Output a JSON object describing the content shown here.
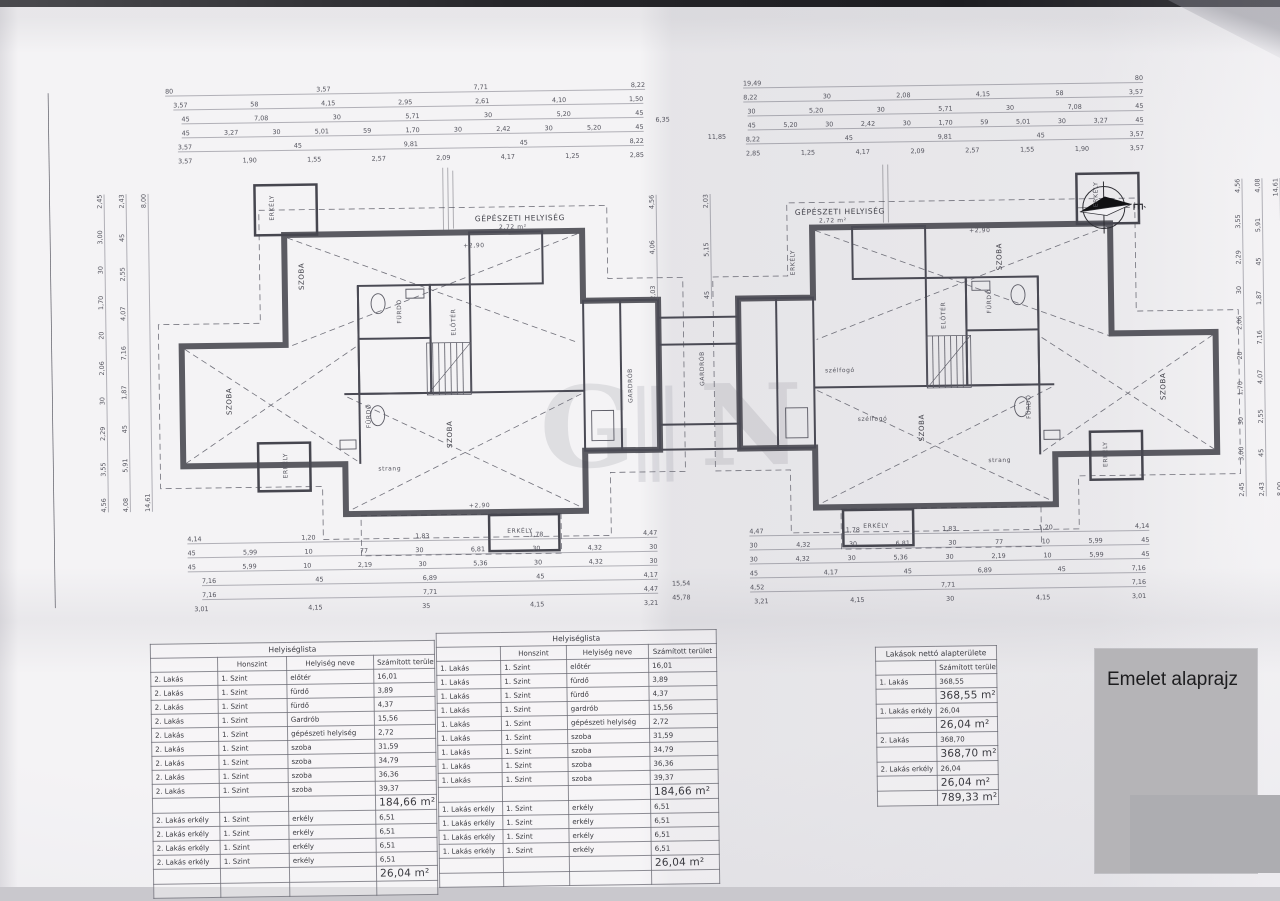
{
  "overlay": {
    "title": "Emelet alaprajz"
  },
  "compass": {
    "north_label": "É"
  },
  "watermark": {
    "letter_g": "G",
    "letter_n": "N"
  },
  "plan": {
    "labels": {
      "erkely": "ERKÉLY",
      "szoba": "SZOBA",
      "furdo": "FÜRDŐ",
      "eloter": "ELŐTÉR",
      "gardrob": "GARDRÓB",
      "gepeszeti": "GÉPÉSZETI HELYISÉG",
      "gepeszeti_area": "2,72 m²",
      "strang": "strang",
      "szelfogo": "szélfogó",
      "level": "+2,90"
    },
    "dims": {
      "top_l": [
        [
          "80",
          "3,57",
          "7,71",
          "8,22"
        ],
        [
          "3,57",
          "58",
          "4,15",
          "2,95",
          "2,61",
          "4,10",
          "1,50"
        ],
        [
          "45",
          "7,08",
          "30",
          "5,71",
          "30",
          "5,20",
          "45"
        ],
        [
          "45",
          "3,27",
          "30",
          "5,01",
          "59",
          "1,70",
          "30",
          "2,42",
          "30",
          "5,20",
          "45"
        ],
        [
          "3,57",
          "45",
          "9,81",
          "45",
          "8,22"
        ],
        [
          "3,57",
          "1,90",
          "1,55",
          "2,57",
          "2,09",
          "4,17",
          "1,25",
          "2,85"
        ]
      ],
      "top_r": [
        [
          "19,49",
          "80"
        ],
        [
          "8,22",
          "30",
          "2,08",
          "4,15",
          "58",
          "3,57"
        ],
        [
          "30",
          "5,20",
          "30",
          "5,71",
          "30",
          "7,08",
          "45"
        ],
        [
          "45",
          "5,20",
          "30",
          "2,42",
          "30",
          "1,70",
          "59",
          "5,01",
          "30",
          "3,27",
          "45"
        ],
        [
          "8,22",
          "45",
          "9,81",
          "45",
          "3,57"
        ],
        [
          "2,85",
          "1,25",
          "4,17",
          "2,09",
          "2,57",
          "1,55",
          "1,90",
          "3,57"
        ]
      ],
      "top_c": [
        "6,35",
        "11,85"
      ],
      "bot_l": [
        [
          "4,14",
          "1,20",
          "1,83",
          "1,78",
          "4,47"
        ],
        [
          "45",
          "5,99",
          "10",
          "77",
          "30",
          "6,81",
          "30",
          "4,32",
          "30"
        ],
        [
          "45",
          "5,99",
          "10",
          "2,19",
          "30",
          "5,36",
          "30",
          "4,32",
          "30"
        ],
        [
          "7,16",
          "45",
          "6,89",
          "45",
          "4,17"
        ],
        [
          "7,16",
          "7,71",
          "4,47"
        ],
        [
          "3,01",
          "4,15",
          "35",
          "4,15",
          "3,21"
        ]
      ],
      "bot_r": [
        [
          "4,47",
          "1,78",
          "1,83",
          "1,20",
          "4,14"
        ],
        [
          "30",
          "4,32",
          "30",
          "6,81",
          "30",
          "77",
          "10",
          "5,99",
          "45"
        ],
        [
          "30",
          "4,32",
          "30",
          "5,36",
          "30",
          "2,19",
          "10",
          "5,99",
          "45"
        ],
        [
          "45",
          "4,17",
          "45",
          "6,89",
          "45",
          "7,16"
        ],
        [
          "4,52",
          "7,71",
          "7,16"
        ],
        [
          "3,21",
          "4,15",
          "30",
          "4,15",
          "3,01"
        ]
      ],
      "bot_c": [
        "15,54",
        "45,78"
      ],
      "left_v": [
        [
          "4,56",
          "3,55",
          "2,29",
          "30",
          "2,06",
          "20",
          "1,70",
          "30",
          "3,00",
          "2,45"
        ],
        [
          "4,08",
          "5,91",
          "45",
          "1,87",
          "7,16",
          "4,07",
          "2,55",
          "45",
          "2,43"
        ],
        [
          "14,61",
          "8,00"
        ]
      ],
      "right_v": [
        [
          "2,45",
          "3,00",
          "30",
          "1,70",
          "20",
          "2,06",
          "30",
          "2,29",
          "3,55",
          "4,56"
        ],
        [
          "2,43",
          "45",
          "2,55",
          "4,07",
          "7,16",
          "1,87",
          "45",
          "5,91",
          "4,08"
        ],
        [
          "8,00",
          "14,61"
        ]
      ],
      "center_v": [
        [
          "2,03",
          "4,06",
          "4,56"
        ],
        [
          "45",
          "5,15",
          "2,03"
        ]
      ]
    }
  },
  "tables": {
    "left": {
      "title": "Helyiséglista",
      "col_headers": [
        "",
        "Honszint",
        "Helyiség neve",
        "Számított terület"
      ],
      "rows": [
        [
          "2. Lakás",
          "1. Szint",
          "előtér",
          "16,01"
        ],
        [
          "2. Lakás",
          "1. Szint",
          "fürdő",
          "3,89"
        ],
        [
          "2. Lakás",
          "1. Szint",
          "fürdő",
          "4,37"
        ],
        [
          "2. Lakás",
          "1. Szint",
          "Gardrób",
          "15,56"
        ],
        [
          "2. Lakás",
          "1. Szint",
          "gépészeti helyiség",
          "2,72"
        ],
        [
          "2. Lakás",
          "1. Szint",
          "szoba",
          "31,59"
        ],
        [
          "2. Lakás",
          "1. Szint",
          "szoba",
          "34,79"
        ],
        [
          "2. Lakás",
          "1. Szint",
          "szoba",
          "36,36"
        ],
        [
          "2. Lakás",
          "1. Szint",
          "szoba",
          "39,37"
        ],
        [
          "",
          "",
          "",
          "184,66 m²"
        ],
        [
          "2. Lakás erkély",
          "1. Szint",
          "erkély",
          "6,51"
        ],
        [
          "2. Lakás erkély",
          "1. Szint",
          "erkély",
          "6,51"
        ],
        [
          "2. Lakás erkély",
          "1. Szint",
          "erkély",
          "6,51"
        ],
        [
          "2. Lakás erkély",
          "1. Szint",
          "erkély",
          "6,51"
        ],
        [
          "",
          "",
          "",
          "26,04 m²"
        ],
        [
          "",
          "",
          "",
          ""
        ]
      ]
    },
    "middle": {
      "title": "Helyiséglista",
      "col_headers": [
        "",
        "Honszint",
        "Helyiség neve",
        "Számított terület"
      ],
      "rows": [
        [
          "1. Lakás",
          "1. Szint",
          "előtér",
          "16,01"
        ],
        [
          "1. Lakás",
          "1. Szint",
          "fürdő",
          "3,89"
        ],
        [
          "1. Lakás",
          "1. Szint",
          "fürdő",
          "4,37"
        ],
        [
          "1. Lakás",
          "1. Szint",
          "gardrób",
          "15,56"
        ],
        [
          "1. Lakás",
          "1. Szint",
          "gépészeti helyiség",
          "2,72"
        ],
        [
          "1. Lakás",
          "1. Szint",
          "szoba",
          "31,59"
        ],
        [
          "1. Lakás",
          "1. Szint",
          "szoba",
          "34,79"
        ],
        [
          "1. Lakás",
          "1. Szint",
          "szoba",
          "36,36"
        ],
        [
          "1. Lakás",
          "1. Szint",
          "szoba",
          "39,37"
        ],
        [
          "",
          "",
          "",
          "184,66 m²"
        ],
        [
          "1. Lakás erkély",
          "1. Szint",
          "erkély",
          "6,51"
        ],
        [
          "1. Lakás erkély",
          "1. Szint",
          "erkély",
          "6,51"
        ],
        [
          "1. Lakás erkély",
          "1. Szint",
          "erkély",
          "6,51"
        ],
        [
          "1. Lakás erkély",
          "1. Szint",
          "erkély",
          "6,51"
        ],
        [
          "",
          "",
          "",
          "26,04 m²"
        ],
        [
          "",
          "",
          "",
          ""
        ]
      ]
    },
    "right": {
      "title": "Lakások nettó alapterülete",
      "col_headers": [
        "",
        "Számított terület"
      ],
      "rows": [
        [
          "1. Lakás",
          "368,55"
        ],
        [
          "",
          "368,55 m²"
        ],
        [
          "1. Lakás erkély",
          "26,04"
        ],
        [
          "",
          "26,04 m²"
        ],
        [
          "2. Lakás",
          "368,70"
        ],
        [
          "",
          "368,70 m²"
        ],
        [
          "2. Lakás erkély",
          "26,04"
        ],
        [
          "",
          "26,04 m²"
        ],
        [
          "",
          "789,33 m²"
        ]
      ]
    }
  }
}
